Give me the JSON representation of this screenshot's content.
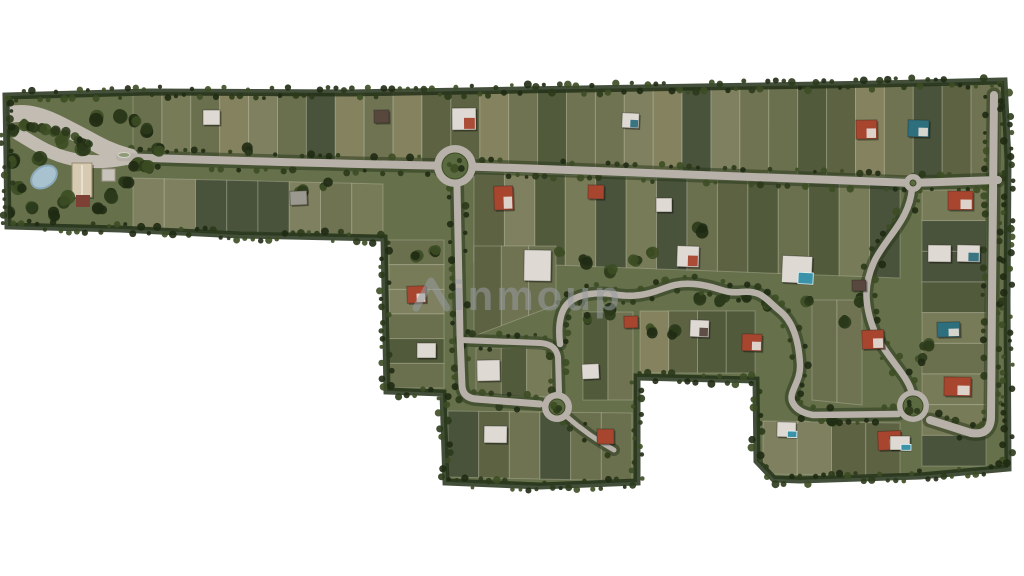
{
  "watermark": {
    "text": "inmoup",
    "color": "#989ca2",
    "opacity": 0.55
  },
  "palette": {
    "background": "#ffffff",
    "base": "#66704b",
    "lot_shades": [
      "#6f7351",
      "#5c6242",
      "#777b58",
      "#525a3c",
      "#6a6f4e",
      "#7e805f",
      "#49523a",
      "#85835f"
    ],
    "lot_line": "rgba(215,215,195,0.30)",
    "road": "#b7b1a9",
    "road_light": "#c2bcb2",
    "tree_dark": "#1f2a13",
    "tree_mid": "#2b3a1b",
    "tree_light": "#3c4d24",
    "pond": "#a9c2cf",
    "pond_edge": "#8aa8b8",
    "clubhouse_roof": "#d6cab2",
    "clubhouse_annex": "#7d4034",
    "roof": {
      "red": "#a8452e",
      "white": "#dedad3",
      "gray": "#9b988f",
      "teal": "#2e6f7d",
      "dark": "#57473d"
    },
    "pool": "#3a93a8"
  },
  "site": {
    "outline": [
      [
        6,
        96
      ],
      [
        150,
        92
      ],
      [
        350,
        93
      ],
      [
        520,
        90
      ],
      [
        700,
        87
      ],
      [
        880,
        84
      ],
      [
        1004,
        81
      ],
      [
        1008,
        160
      ],
      [
        1007,
        300
      ],
      [
        1008,
        468
      ],
      [
        920,
        476
      ],
      [
        800,
        480
      ],
      [
        774,
        479
      ],
      [
        757,
        461
      ],
      [
        756,
        380
      ],
      [
        637,
        377
      ],
      [
        637,
        482
      ],
      [
        540,
        486
      ],
      [
        446,
        482
      ],
      [
        443,
        393
      ],
      [
        387,
        391
      ],
      [
        384,
        238
      ],
      [
        240,
        235
      ],
      [
        120,
        229
      ],
      [
        8,
        226
      ]
    ]
  },
  "lot_bands": [
    {
      "x0": 133,
      "x1": 1000,
      "top": [
        92,
        84
      ],
      "bot": [
        157,
        180
      ],
      "n": 30
    },
    {
      "x0": 133,
      "x1": 383,
      "top": [
        178,
        184
      ],
      "bot": [
        230,
        235
      ],
      "n": 8
    },
    {
      "x0": 474,
      "x1": 900,
      "top": [
        172,
        186
      ],
      "bot": [
        262,
        278
      ],
      "n": 14
    },
    {
      "x0": 389,
      "x1": 444,
      "top": [
        240,
        240
      ],
      "bot": [
        388,
        388
      ],
      "n": 6,
      "dir": "h"
    },
    {
      "x0": 474,
      "x1": 556,
      "top": [
        246,
        246
      ],
      "bot": [
        336,
        305
      ],
      "n": 3
    },
    {
      "x0": 476,
      "x1": 552,
      "top": [
        348,
        348
      ],
      "bot": [
        395,
        397
      ],
      "n": 3
    },
    {
      "x0": 583,
      "x1": 633,
      "top": [
        312,
        312
      ],
      "bot": [
        400,
        400
      ],
      "n": 2
    },
    {
      "x0": 448,
      "x1": 632,
      "top": [
        411,
        413
      ],
      "bot": [
        477,
        481
      ],
      "n": 6
    },
    {
      "x0": 640,
      "x1": 755,
      "top": [
        311,
        311
      ],
      "bot": [
        373,
        373
      ],
      "n": 4
    },
    {
      "x0": 763,
      "x1": 900,
      "top": [
        421,
        423
      ],
      "bot": [
        474,
        476
      ],
      "n": 4
    },
    {
      "x0": 812,
      "x1": 862,
      "top": [
        300,
        300
      ],
      "bot": [
        400,
        405
      ],
      "n": 2
    },
    {
      "x0": 922,
      "x1": 986,
      "top": [
        190,
        190
      ],
      "bot": [
        466,
        466
      ],
      "n": 9,
      "dir": "h"
    }
  ],
  "roads": [
    {
      "name": "entrance-avenue",
      "d": "M-2,118 C25,107 48,118 72,131 C96,143 106,151 130,157",
      "w": 17,
      "light": true
    },
    {
      "name": "entrance-apron",
      "d": "M12,130 C32,142 48,154 72,159 C92,163 108,162 124,159",
      "w": 13,
      "light": true
    },
    {
      "name": "main-road",
      "d": "M120,157 C260,162 360,164 452,166 C620,171 800,179 912,183 L998,180",
      "w": 8,
      "tree": true
    },
    {
      "name": "north-south-road",
      "d": "M457,186 L460,336 L462,386 Q463,398 476,399 L540,404",
      "w": 7,
      "tree": true
    },
    {
      "name": "loop-connector",
      "d": "M461,340 L540,343 Q556,344 558,357 L559,392",
      "w": 6,
      "tree": true
    },
    {
      "name": "s-curve-road",
      "d": "M560,344 C556,308 568,297 590,294 C612,291 618,298 640,295 C663,292 668,282 694,284 C719,286 722,294 741,292 C763,290 766,300 780,311 C795,323 799,345 800,364 C801,382 789,391 792,401 Q796,412 813,415 L898,414",
      "w": 6.5,
      "tree": true
    },
    {
      "name": "east-wiggle-road",
      "d": "M912,188 C910,220 885,238 874,262 C865,282 863,302 874,330 C885,356 905,372 911,390",
      "w": 6.5,
      "tree": true
    },
    {
      "name": "east-boundary-road",
      "d": "M994,95 L992,300 L991,418 Q990,436 971,433 L930,420",
      "w": 8,
      "tree": true
    },
    {
      "name": "cul-de-sac-spur",
      "d": "M566,416 C582,430 596,440 614,450",
      "w": 5,
      "tree": true
    }
  ],
  "roundabouts": [
    {
      "name": "roundabout-main",
      "cx": 455,
      "cy": 166,
      "ro": 21,
      "ri": 13
    },
    {
      "name": "roundabout-south-west",
      "cx": 557,
      "cy": 407,
      "ro": 15,
      "ri": 8
    },
    {
      "name": "roundabout-south-east",
      "cx": 913,
      "cy": 406,
      "ro": 16,
      "ri": 10
    },
    {
      "name": "junction-island-east",
      "cx": 913,
      "cy": 183,
      "ro": 9,
      "ri": 3
    }
  ],
  "entrance": {
    "pond": {
      "cx": 44,
      "cy": 177,
      "rx": 14,
      "ry": 10,
      "rot": -35
    },
    "clubhouse": {
      "x": 72,
      "y": 163,
      "w": 20,
      "h": 34
    },
    "annex": {
      "x": 76,
      "y": 195,
      "w": 14,
      "h": 12
    },
    "pad": {
      "x": 102,
      "y": 169,
      "w": 13,
      "h": 12
    },
    "island": {
      "cx": 124,
      "cy": 155,
      "rx": 6,
      "ry": 2.5
    },
    "trees": [
      [
        12,
        160
      ],
      [
        20,
        186
      ],
      [
        8,
        212
      ],
      [
        30,
        206
      ],
      [
        54,
        214
      ],
      [
        66,
        200
      ],
      [
        100,
        210
      ],
      [
        113,
        196
      ],
      [
        126,
        181
      ],
      [
        136,
        166
      ],
      [
        14,
        130
      ],
      [
        98,
        117
      ],
      [
        120,
        114
      ],
      [
        134,
        121
      ],
      [
        146,
        130
      ],
      [
        60,
        140
      ],
      [
        84,
        147
      ],
      [
        40,
        160
      ],
      [
        148,
        168
      ],
      [
        160,
        150
      ]
    ],
    "median_trees": [
      [
        22,
        124
      ],
      [
        32,
        126
      ],
      [
        43,
        128
      ],
      [
        54,
        131
      ],
      [
        66,
        134
      ],
      [
        78,
        138
      ],
      [
        90,
        143
      ]
    ]
  },
  "tree_clusters": [
    [
      560,
      253
    ],
    [
      584,
      262
    ],
    [
      610,
      270
    ],
    [
      636,
      262
    ],
    [
      652,
      252
    ],
    [
      700,
      299
    ],
    [
      722,
      300
    ],
    [
      745,
      296
    ],
    [
      768,
      305
    ],
    [
      590,
      318
    ],
    [
      610,
      312
    ],
    [
      418,
      258
    ],
    [
      435,
      250
    ],
    [
      300,
      189
    ],
    [
      326,
      185
    ],
    [
      860,
      300
    ],
    [
      846,
      322
    ],
    [
      832,
      418
    ],
    [
      808,
      300
    ],
    [
      920,
      360
    ],
    [
      926,
      345
    ],
    [
      650,
      330
    ],
    [
      674,
      332
    ],
    [
      248,
      150
    ],
    [
      700,
      230
    ]
  ],
  "houses": [
    {
      "x": 203,
      "y": 110,
      "w": 17,
      "h": 15,
      "roof": "white"
    },
    {
      "x": 374,
      "y": 110,
      "w": 15,
      "h": 13,
      "roof": "dark"
    },
    {
      "x": 452,
      "y": 108,
      "w": 24,
      "h": 22,
      "roof": "white",
      "accent": "red"
    },
    {
      "x": 622,
      "y": 113,
      "w": 17,
      "h": 15,
      "roof": "white",
      "accent": "teal"
    },
    {
      "x": 856,
      "y": 120,
      "w": 21,
      "h": 19,
      "roof": "red",
      "accent": "white"
    },
    {
      "x": 908,
      "y": 120,
      "w": 21,
      "h": 17,
      "roof": "teal",
      "accent": "white"
    },
    {
      "x": 948,
      "y": 191,
      "w": 25,
      "h": 19,
      "roof": "red",
      "accent": "white"
    },
    {
      "x": 928,
      "y": 245,
      "w": 23,
      "h": 17,
      "roof": "white"
    },
    {
      "x": 957,
      "y": 245,
      "w": 23,
      "h": 17,
      "roof": "white",
      "accent": "teal"
    },
    {
      "x": 290,
      "y": 191,
      "w": 17,
      "h": 14,
      "roof": "gray"
    },
    {
      "x": 494,
      "y": 186,
      "w": 19,
      "h": 24,
      "roof": "red",
      "accent": "white"
    },
    {
      "x": 588,
      "y": 185,
      "w": 16,
      "h": 14,
      "roof": "red"
    },
    {
      "x": 656,
      "y": 198,
      "w": 16,
      "h": 14,
      "roof": "white"
    },
    {
      "x": 524,
      "y": 250,
      "w": 27,
      "h": 31,
      "roof": "white"
    },
    {
      "x": 407,
      "y": 286,
      "w": 19,
      "h": 17,
      "roof": "red",
      "accent": "white"
    },
    {
      "x": 677,
      "y": 246,
      "w": 22,
      "h": 21,
      "roof": "white",
      "accent": "red"
    },
    {
      "x": 782,
      "y": 256,
      "w": 30,
      "h": 27,
      "roof": "white",
      "pool": true
    },
    {
      "x": 852,
      "y": 280,
      "w": 14,
      "h": 11,
      "roof": "dark"
    },
    {
      "x": 417,
      "y": 343,
      "w": 19,
      "h": 15,
      "roof": "white"
    },
    {
      "x": 477,
      "y": 360,
      "w": 23,
      "h": 21,
      "roof": "white"
    },
    {
      "x": 582,
      "y": 364,
      "w": 17,
      "h": 15,
      "roof": "white"
    },
    {
      "x": 624,
      "y": 316,
      "w": 14,
      "h": 12,
      "roof": "red"
    },
    {
      "x": 690,
      "y": 320,
      "w": 19,
      "h": 17,
      "roof": "white",
      "accent": "dark"
    },
    {
      "x": 742,
      "y": 334,
      "w": 20,
      "h": 17,
      "roof": "red",
      "accent": "white"
    },
    {
      "x": 862,
      "y": 330,
      "w": 22,
      "h": 19,
      "roof": "red",
      "accent": "white"
    },
    {
      "x": 484,
      "y": 426,
      "w": 23,
      "h": 17,
      "roof": "white"
    },
    {
      "x": 597,
      "y": 429,
      "w": 17,
      "h": 15,
      "roof": "red"
    },
    {
      "x": 777,
      "y": 422,
      "w": 19,
      "h": 15,
      "roof": "white",
      "pool": true
    },
    {
      "x": 878,
      "y": 431,
      "w": 23,
      "h": 19,
      "roof": "red",
      "accent": "white"
    },
    {
      "x": 944,
      "y": 377,
      "w": 27,
      "h": 19,
      "roof": "red",
      "accent": "white"
    },
    {
      "x": 937,
      "y": 322,
      "w": 23,
      "h": 15,
      "roof": "teal",
      "accent": "white"
    },
    {
      "x": 890,
      "y": 436,
      "w": 20,
      "h": 14,
      "roof": "white",
      "pool": true
    }
  ]
}
